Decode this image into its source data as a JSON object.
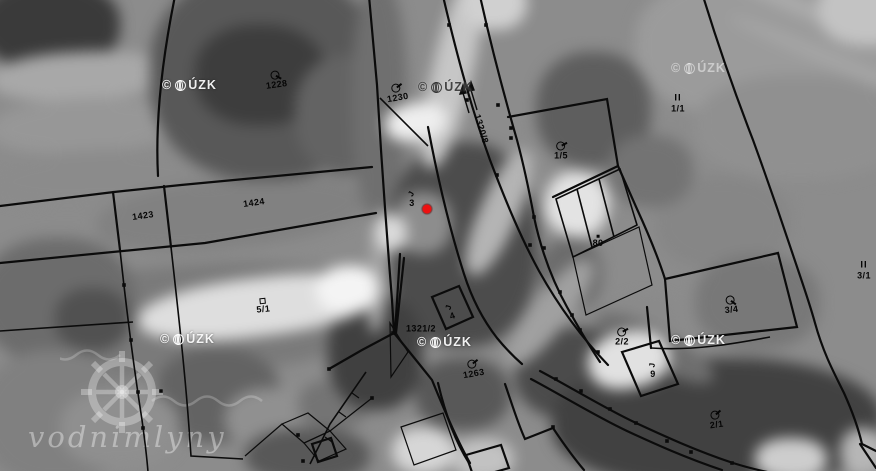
{
  "map": {
    "marker": {
      "x": 427,
      "y": 209,
      "color": "#ee1010"
    },
    "labels": [
      {
        "text": "1228",
        "x": 276,
        "y": 80,
        "rot": -8,
        "symbol": "orchard-symbol",
        "sym_rot": -15
      },
      {
        "text": "1230",
        "x": 397,
        "y": 93,
        "rot": -10,
        "symbol": "orchard-symbol",
        "sym_rot": -80
      },
      {
        "text": "1320/8",
        "x": 481,
        "y": 129,
        "rot": 73,
        "name": "road-parcel-label"
      },
      {
        "text": "1423",
        "x": 143,
        "y": 216,
        "rot": -8
      },
      {
        "text": "1424",
        "x": 254,
        "y": 203,
        "rot": -8
      },
      {
        "text": "1/5",
        "x": 561,
        "y": 151,
        "rot": 0,
        "symbol": "orchard-symbol",
        "sym_rot": -80
      },
      {
        "text": "1/1",
        "x": 678,
        "y": 103,
        "rot": 0,
        "symbol": "roman-ii-symbol",
        "symbol_text": "II"
      },
      {
        "text": "3",
        "x": 412,
        "y": 199,
        "rot": 0,
        "symbol": "house-symbol",
        "symbol_text": "J",
        "sym_rot": -60
      },
      {
        "text": "80",
        "x": 598,
        "y": 241,
        "rot": 0,
        "symbol": "dot-symbol"
      },
      {
        "text": "5/1",
        "x": 263,
        "y": 306,
        "rot": -6,
        "symbol": "square-symbol"
      },
      {
        "text": "1321/2",
        "x": 421,
        "y": 329,
        "rot": 0
      },
      {
        "text": "4",
        "x": 451,
        "y": 312,
        "rot": -20,
        "symbol": "house-symbol",
        "symbol_text": "J",
        "sym_rot": -55
      },
      {
        "text": "1263",
        "x": 473,
        "y": 369,
        "rot": -10,
        "symbol": "orchard-symbol",
        "sym_rot": -80
      },
      {
        "text": "2/2",
        "x": 622,
        "y": 337,
        "rot": 0,
        "symbol": "orchard-symbol",
        "sym_rot": -80
      },
      {
        "text": "9",
        "x": 653,
        "y": 370,
        "rot": 0,
        "symbol": "house-symbol",
        "symbol_text": "J",
        "sym_rot": -85
      },
      {
        "text": "3/4",
        "x": 731,
        "y": 305,
        "rot": -6,
        "symbol": "orchard-symbol",
        "sym_rot": -10
      },
      {
        "text": "3/1",
        "x": 864,
        "y": 270,
        "rot": 0,
        "symbol": "roman-ii-symbol",
        "symbol_text": "II"
      },
      {
        "text": "2/1",
        "x": 716,
        "y": 420,
        "rot": -8,
        "symbol": "orchard-symbol",
        "sym_rot": -85
      }
    ],
    "copyright": {
      "full_text": "© ČÚZK",
      "prefix": "©",
      "suffix": "ÚZK",
      "instances": [
        {
          "x": 162,
          "y": 79,
          "variant": "light"
        },
        {
          "x": 418,
          "y": 81,
          "variant": "dark"
        },
        {
          "x": 671,
          "y": 62,
          "variant": "faint"
        },
        {
          "x": 160,
          "y": 333,
          "variant": "light"
        },
        {
          "x": 417,
          "y": 336,
          "variant": "light"
        },
        {
          "x": 671,
          "y": 334,
          "variant": "light"
        }
      ]
    },
    "watermark_brand": {
      "text": "vodnimlyny"
    }
  },
  "colors": {
    "cadastral_line": "#0b0b0b",
    "label_text": "#060606",
    "marker_red": "#ee1010",
    "watermark_white": "rgba(255,255,255,0.9)"
  }
}
